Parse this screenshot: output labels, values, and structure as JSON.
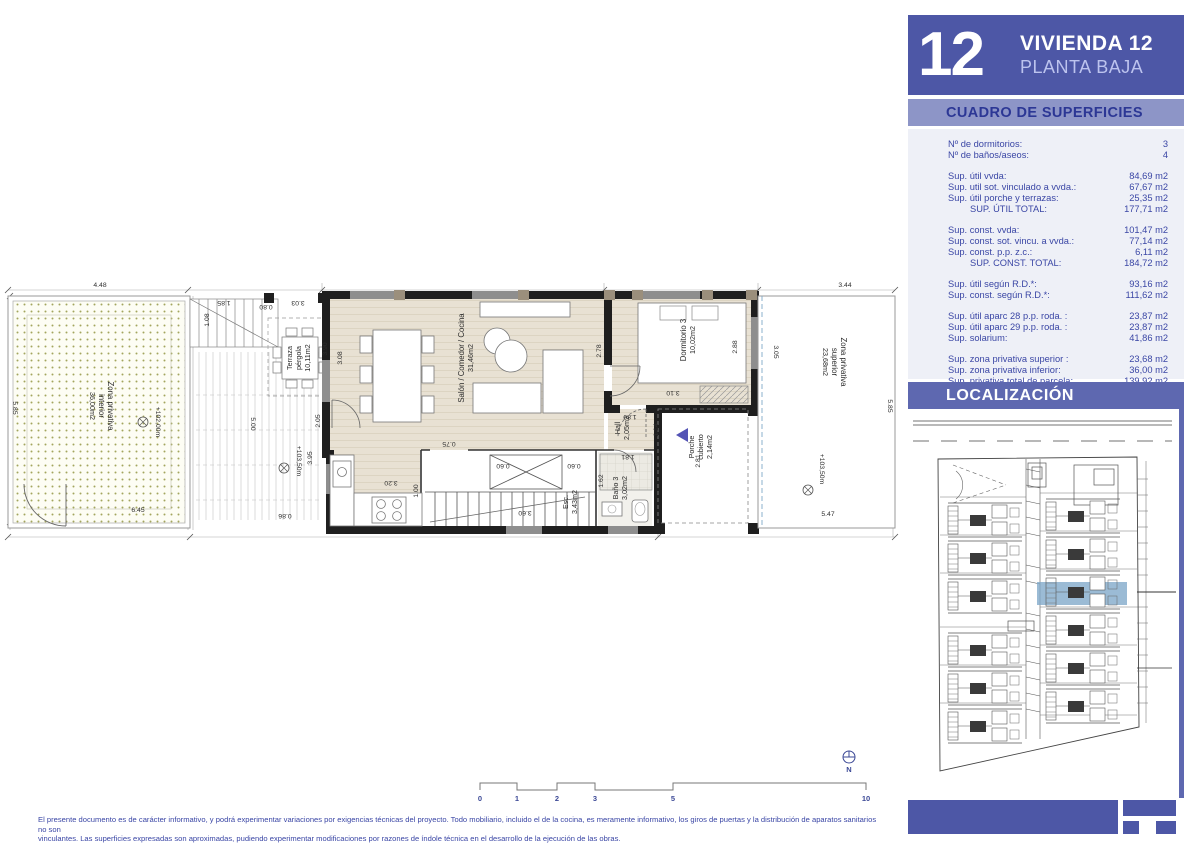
{
  "header": {
    "number": "12",
    "title": "VIVIENDA 12",
    "subtitle": "PLANTA BAJA"
  },
  "surfaces": {
    "band_title": "CUADRO DE SUPERFICIES",
    "rows": [
      {
        "label": "Nº de dormitorios:",
        "value": "3"
      },
      {
        "label": "Nº de baños/aseos:",
        "value": "4",
        "gap_after": true
      },
      {
        "label": "Sup. útil vvda:",
        "value": "84,69 m2"
      },
      {
        "label": "Sup. util sot. vinculado a vvda.:",
        "value": "67,67 m2"
      },
      {
        "label": "Sup. útil porche y terrazas:",
        "value": "25,35 m2"
      },
      {
        "label": "SUP. ÚTIL TOTAL:",
        "value": "177,71 m2",
        "indent": true,
        "gap_after": true
      },
      {
        "label": "Sup. const. vvda:",
        "value": "101,47 m2"
      },
      {
        "label": "Sup. const. sot. vincu. a vvda.:",
        "value": "77,14 m2"
      },
      {
        "label": "Sup. const. p.p. z.c.:",
        "value": "6,11 m2"
      },
      {
        "label": "SUP. CONST. TOTAL:",
        "value": "184,72 m2",
        "indent": true,
        "gap_after": true
      },
      {
        "label": "Sup. útil según R.D.*:",
        "value": "93,16 m2"
      },
      {
        "label": "Sup. const. según R.D.*:",
        "value": "111,62 m2",
        "gap_after": true
      },
      {
        "label": "Sup. útil aparc 28 p.p. roda. :",
        "value": "23,87 m2"
      },
      {
        "label": "Sup. útil aparc 29 p.p. roda. :",
        "value": "23,87 m2"
      },
      {
        "label": "Sup. solarium:",
        "value": "41,86 m2",
        "gap_after": true
      },
      {
        "label": "Sup. zona privativa superior :",
        "value": "23,68 m2"
      },
      {
        "label": "Sup. zona privativa inferior:",
        "value": "36,00 m2"
      },
      {
        "label": "Sup. privativa total de parcela:",
        "value": "139,92 m2"
      }
    ]
  },
  "localizacion": {
    "band_title": "LOCALIZACIÓN"
  },
  "plan": {
    "rooms": {
      "zona_interior": {
        "l1": "Zona privativa",
        "l2": "interior",
        "area": "36,00m2"
      },
      "zona_superior": {
        "l1": "Zona privativa",
        "l2": "superior",
        "area": "23,68m2"
      },
      "terraza": {
        "l1": "Terraza",
        "l2": "pérgola",
        "area": "10,11m2"
      },
      "salon": {
        "name": "Salón / Comedor / Cocina",
        "area": "31,46m2"
      },
      "dormitorio3": {
        "name": "Dormitorio 3",
        "area": "10,02m2"
      },
      "hall": {
        "name": "Hall",
        "area": "2,05m2"
      },
      "bano3": {
        "name": "Baño 3",
        "area": "3,02m2"
      },
      "esc": {
        "name": "Esc.",
        "area": "3,43m2"
      },
      "porche": {
        "l1": "Porche",
        "l2": "cubierto",
        "area": "2,14m2"
      }
    },
    "levels": {
      "garden": "+102,00m",
      "terrace": "+103,50m",
      "upper": "+103,50m"
    },
    "dims": {
      "d448": "4.48",
      "d585l": "5.85",
      "d645": "6.45",
      "d108": "1.08",
      "d185": "1.85",
      "d080": "0.80",
      "d303": "3.03",
      "d390": "3.90",
      "d205": "2.05",
      "d500": "5.00",
      "d395": "3.95",
      "d086": "0.86",
      "d308": "3.08",
      "d278": "2.78",
      "d288": "2.88",
      "d310": "3.10",
      "d180": "1.80",
      "d114": "1.14",
      "d281": "2.81",
      "d060a": "0.60",
      "d060b": "0.60",
      "d360": "3.60",
      "d075": "0.75",
      "d320": "3.20",
      "d100": "1.00",
      "d162": "1.62",
      "d181": "1.81",
      "d344": "3.44",
      "d305": "3.05",
      "d585r": "5.85",
      "d547": "5.47"
    }
  },
  "scalebar": {
    "t0": "0",
    "t1": "1",
    "t2": "2",
    "t3": "3",
    "t5": "5",
    "t10": "10",
    "north": "N"
  },
  "disclaimer": {
    "line1": "El presente documento es de carácter informativo, y podrá experimentar variaciones por exigencias técnicas del proyecto. Todo mobiliario, incluido el de la cocina, es meramente informativo, los giros de puertas y la distribución de aparatos sanitarios no son",
    "line2": "vinculantes. Las superficies expresadas son aproximadas, pudiendo experimentar modificaciones por razones de índole técnica en el desarrollo de la ejecución de las obras."
  },
  "colors": {
    "primary_blue": "#4d57a6",
    "band_blue": "#8d95c7",
    "band_text": "#2c3795",
    "loc_blue": "#5e68b0",
    "table_bg": "#eef0f7",
    "text_blue": "#3a46a5",
    "highlight_blue": "#7fa8c9",
    "entry_arrow": "#5353b5",
    "wall": "#1f1f1f",
    "wood_floor": "#e8e1d3",
    "garden_dot": "#a3a55e"
  }
}
